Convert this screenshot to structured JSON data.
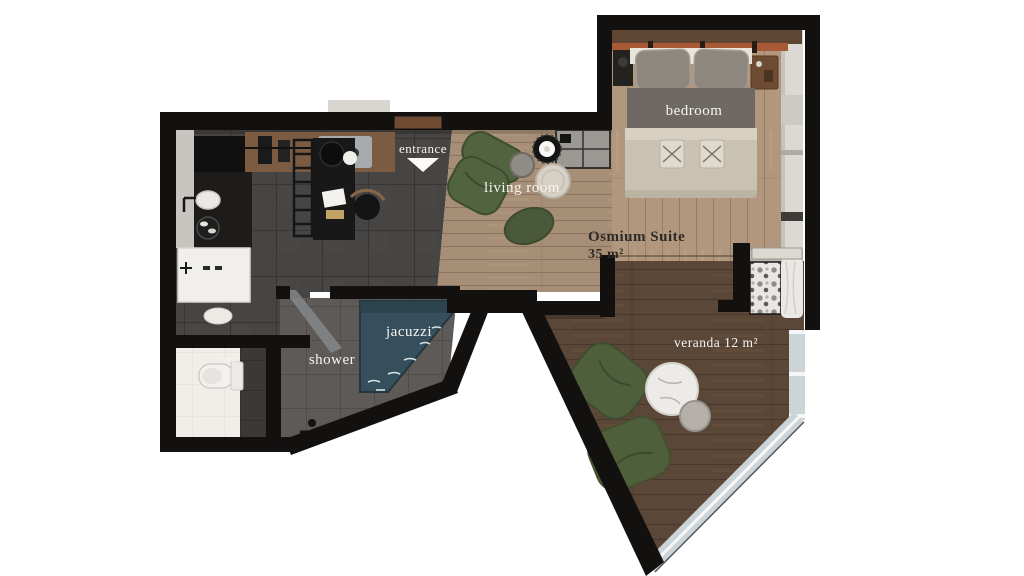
{
  "suite": {
    "name": "Osmium Suite",
    "area": "35 m²"
  },
  "rooms": {
    "entrance": "entrance",
    "living_room": "living room",
    "bedroom": "bedroom",
    "wc": "wc",
    "shower": "shower",
    "jacuzzi": "jacuzzi",
    "veranda": "veranda 12 m²"
  },
  "colors": {
    "wall": "#121110",
    "jacuzzi_water": "#35505c",
    "armchair_green": "#52633f",
    "pouf_green": "#49593a",
    "bean_bag_green": "#4f5f3c",
    "bed_blanket": "#c9c1b1",
    "beam_orange": "#a85a36",
    "label_light": "#f6f4ef",
    "label_dark": "#2f2a25"
  }
}
